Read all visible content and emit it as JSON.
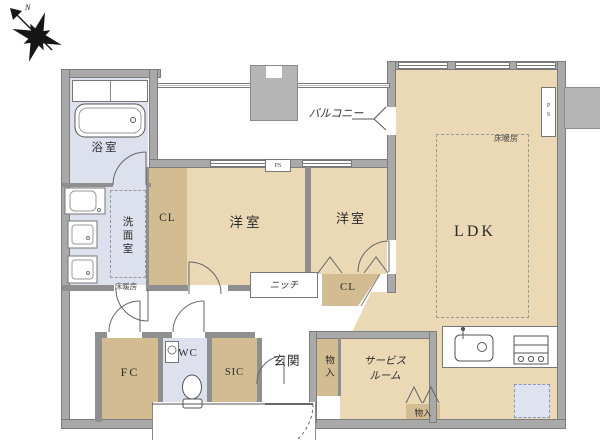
{
  "compass": {
    "north_label": "N"
  },
  "labels": {
    "bathroom": "浴室",
    "washroom": "洗面室",
    "floor_heating_washroom": "床暖房",
    "closet_main": "CL",
    "bedroom_left": "洋室",
    "bedroom_right": "洋室",
    "closet_hall": "CL",
    "ldk": "LDK",
    "floor_heating_ldk": "床暖房",
    "balcony": "バルコニー",
    "niche": "ニッチ",
    "wc": "WC",
    "sic": "SIC",
    "fc": "FC",
    "entrance": "玄関",
    "service_room_line1": "サービス",
    "service_room_line2": "ルーム",
    "storage_hall": "物入",
    "storage_service": "物入",
    "ps_bedroom": "PS",
    "ps_ldk": "PS"
  },
  "colors": {
    "room_fill": "#ead9b4",
    "closet_fill": "#d3bc92",
    "wet_area_fill": "#dde1ee",
    "wall_gray": "#a9a9a9",
    "balcony_block_gray": "#b5b5b5",
    "fridge_fill": "#dde4f0",
    "line_dark": "#555555"
  }
}
